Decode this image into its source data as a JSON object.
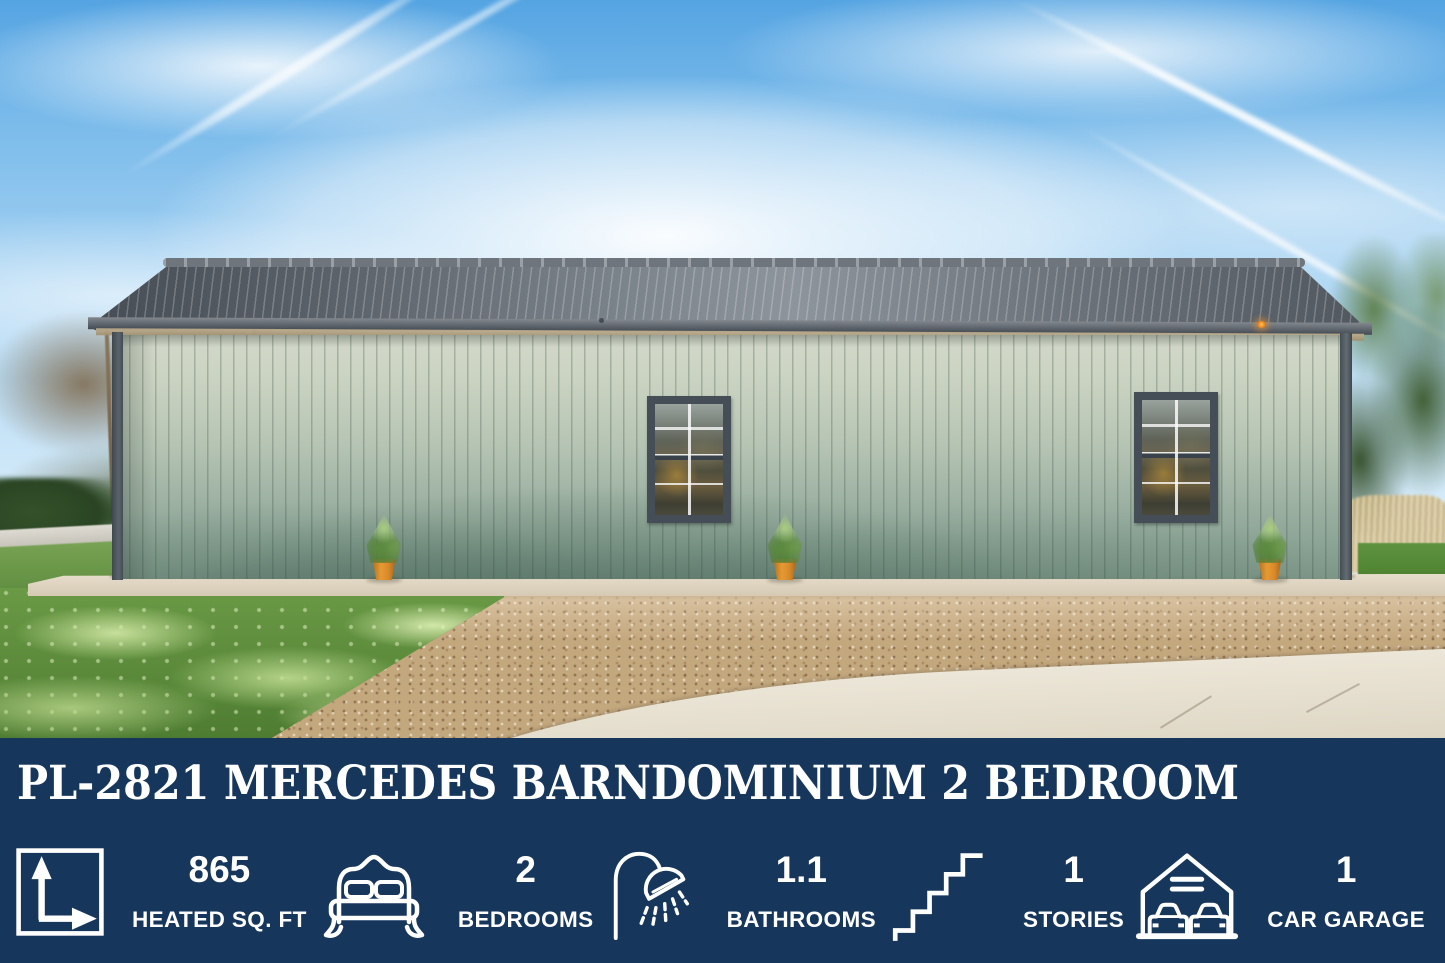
{
  "title": "PL-2821 MERCEDES BARNDOMINIUM 2 BEDROOM",
  "colors": {
    "banner_navy": "#16365c",
    "text_white": "#ffffff",
    "pot_orange": "#d8882a",
    "roof_gray": "#5a6068",
    "siding_sage": "#b6c4b4"
  },
  "stats": [
    {
      "icon": "area-dimensions-icon",
      "value": "865",
      "label": "HEATED SQ. FT"
    },
    {
      "icon": "bed-icon",
      "value": "2",
      "label": "BEDROOMS"
    },
    {
      "icon": "shower-icon",
      "value": "1.1",
      "label": "BATHROOMS"
    },
    {
      "icon": "stairs-icon",
      "value": "1",
      "label": "STORIES"
    },
    {
      "icon": "garage-icon",
      "value": "1",
      "label": "CAR GARAGE"
    }
  ]
}
